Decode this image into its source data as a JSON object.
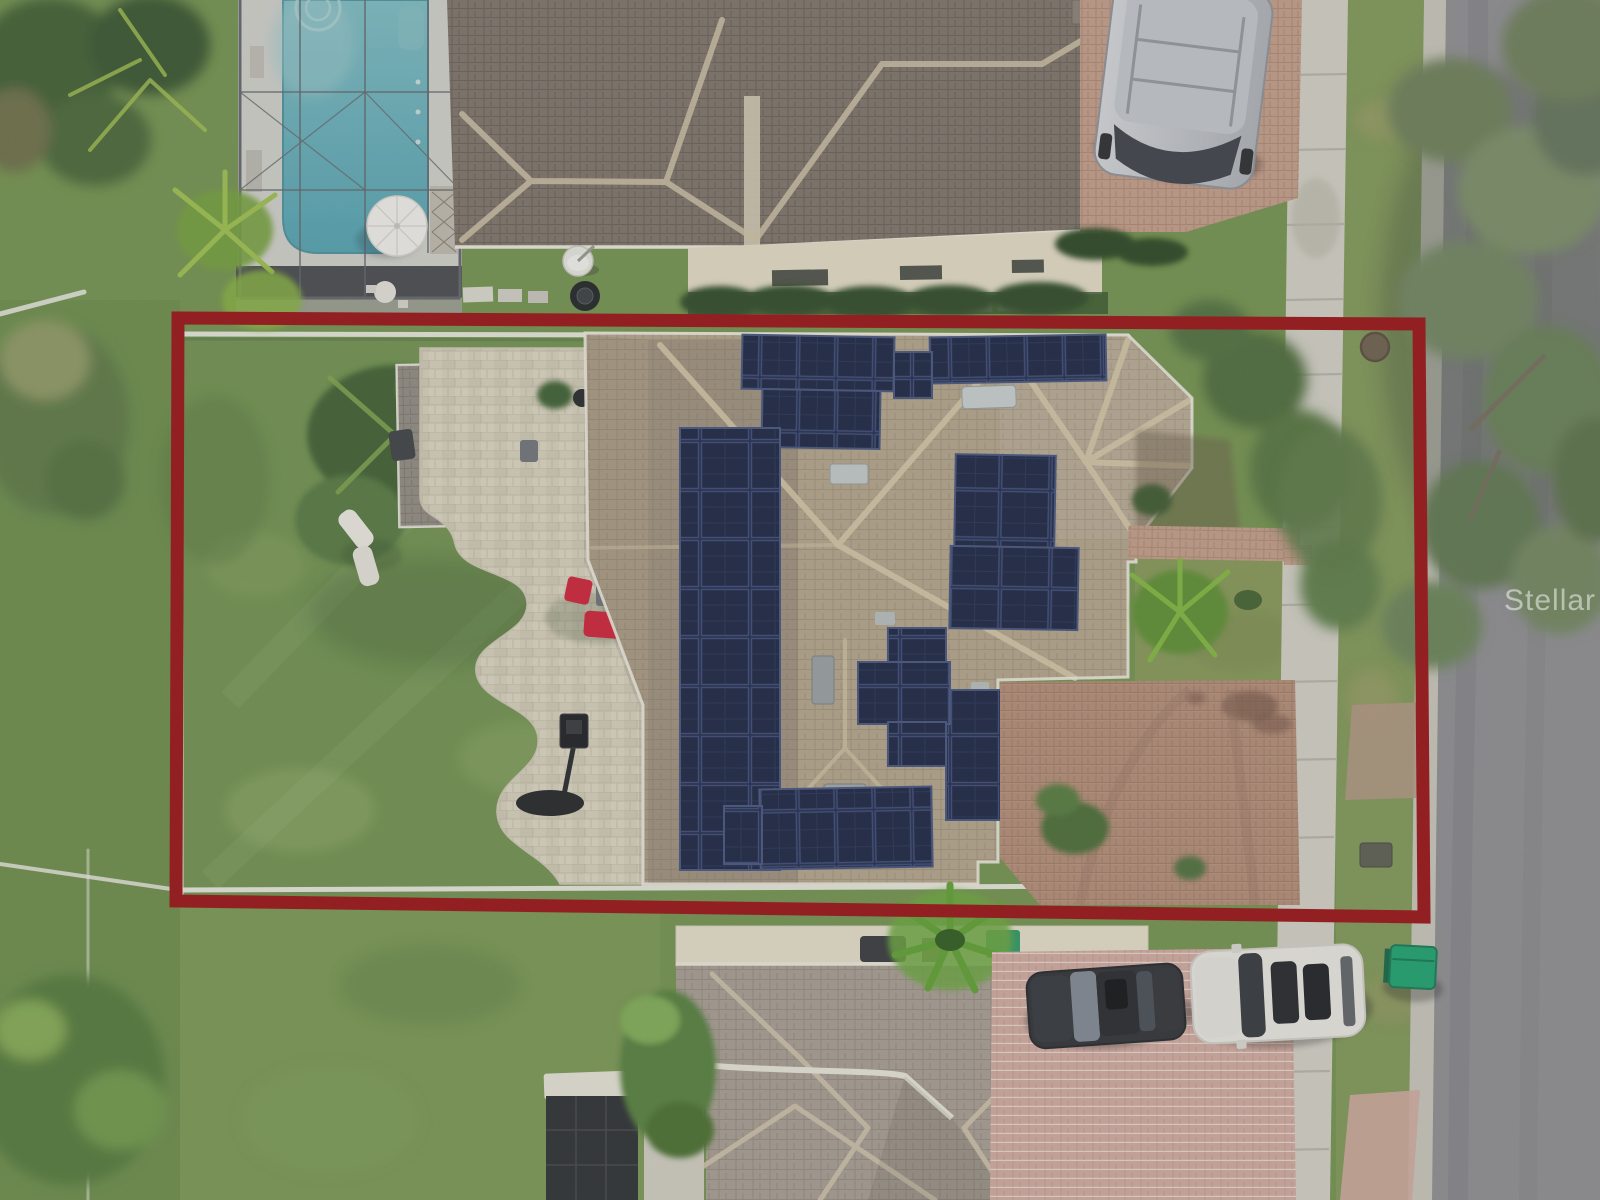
{
  "photo": {
    "description": "Aerial drone photo of a residential lot outlined in red: home with rooftop solar arrays, paver patio with red loungers, shed, lawn; neighboring screened pool at top, street with sidewalk and oak canopy at right, two cars on the lower neighbor driveway",
    "watermark_text": "Stellar MLS"
  },
  "colors": {
    "boundary-red": "#9b1114",
    "solar-navy": "#202b4a",
    "solar-navy-deep": "#1b2542",
    "pool-teal": "#6fc0cb",
    "pool-teal-deep": "#55adbd",
    "roof-tan": "#b4a68d",
    "roof-brown": "#7e746a",
    "roof-light": "#a89e92",
    "roof-shed": "#9b948b",
    "grass-green": "#74944e",
    "street-gray": "#8f8f92",
    "sidewalk-gray": "#d3d1c6",
    "patio-cream": "#d8d1bd",
    "drive-rust": "#b58d77",
    "drive-pink": "#d2aba0",
    "drive-rose": "#c49d88",
    "furniture-red": "#cf2238",
    "bin-green": "#1ca26f",
    "fence-white": "#f0efe8",
    "watermark-white": "rgba(255,255,255,0.50)"
  }
}
